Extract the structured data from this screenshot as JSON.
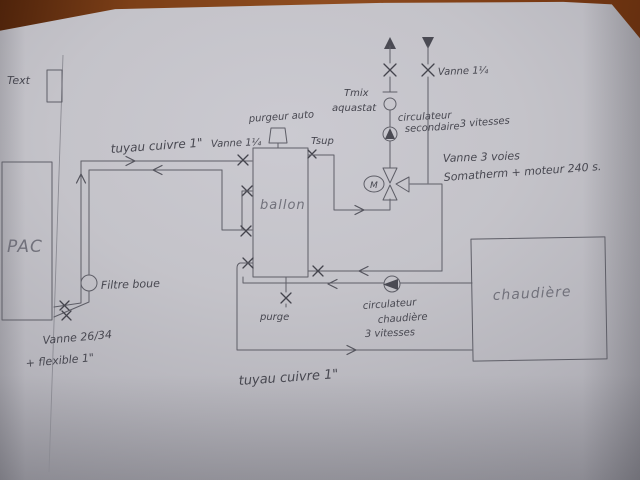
{
  "colors": {
    "pencil": "#5e5e67",
    "handwriting": "#474750",
    "paper_light": "#cbcad1",
    "paper_dark": "#a3a2aa",
    "wood": "#7c3f17"
  },
  "labels": {
    "text_sensor": "Text",
    "pac": "PAC",
    "tuyau_cuivre_top": "tuyau cuivre 1\"",
    "vanne_ballon": "Vanne 1¼",
    "purgeur_auto": "purgeur auto",
    "tsup": "Tsup",
    "ballon": "ballon",
    "tmix": {
      "lines": [
        "Tmix",
        "aquastat"
      ]
    },
    "circulateur_secondaire": {
      "lines": [
        "circulateur",
        "secondaire",
        "3 vitesses"
      ]
    },
    "vanne_retour": "Vanne 1¼",
    "vanne_3_voies": {
      "lines": [
        "Vanne 3 voies",
        "Somatherm  + moteur 240 s."
      ]
    },
    "filtre_boue": "Filtre boue",
    "vanne_26_34": {
      "lines": [
        "Vanne 26/34",
        "+ flexible 1\""
      ]
    },
    "purge": "purge",
    "circulateur_chaudiere": {
      "lines": [
        "circulateur",
        "chaudière",
        "3 vitesses"
      ]
    },
    "chaudiere": "chaudière",
    "tuyau_cuivre_bottom": "tuyau cuivre 1\"",
    "motor": "M"
  }
}
